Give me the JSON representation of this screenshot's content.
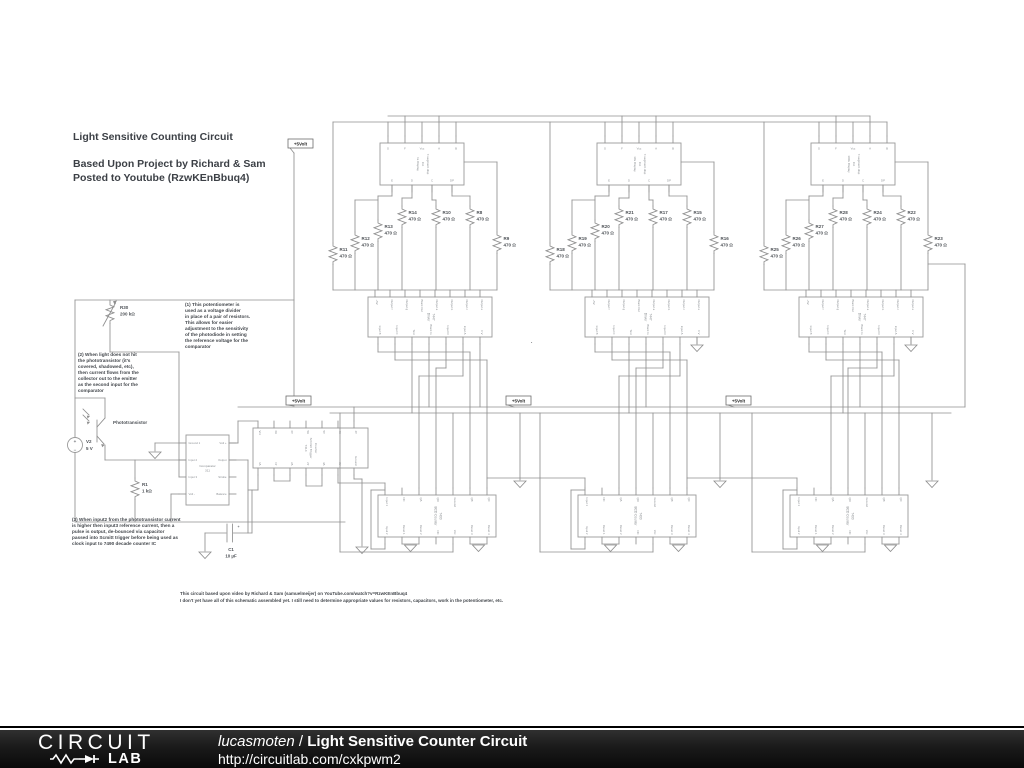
{
  "title": {
    "line1": "Light Sensitive Counting Circuit",
    "line2": "Based Upon Project by Richard & Sam\nPosted to Youtube (RzwKEnBbuq4)"
  },
  "annotations": {
    "note1": "(1) This potentiometer is\nused as a voltage divider\nin place of a pair of resistors.\nThis allows for easier\nadjustment to the sensitivity\nof the photodiode in setting\nthe reference voltage for the\ncomparator",
    "note2": "(2) When light does not hit\nthe phototransistor (it's\ncovered, shadowed, etc),\nthen current flows from the\ncollector out to the emitter\nas the second input for the\ncomparator",
    "note3": "(3) When input2 from the phototransistor current\nis higher then input3 reference current, then a\npulse is output, de-bounced via capacitor\npassed into Scmitt trigger before being used as\nclock input to 7490 decade counter IC",
    "footnote": "This circuit based upon video by Richard & Sam (samuelmeijer) on YouTube.com/watch?v=RzwKEnBbuq4\nI don't yet have all of this schematic assembled yet. I still need to determine appropriate values for resistors, capacitors, work in the potentiometer, etc."
  },
  "schematic": {
    "net_flag": "+5Volt",
    "dot": ".",
    "display": {
      "top_pins": [
        "G",
        "F",
        "Vcc",
        "A",
        "B"
      ],
      "bottom_pins": [
        "E",
        "D",
        "C",
        "DP"
      ]
    },
    "driver": {
      "title_lines": [
        "Driver",
        "7447"
      ],
      "top_pins": [
        "+5V",
        "Output f",
        "Output g",
        "Blank Out",
        "Output a",
        "Output b",
        "Output c",
        "Output e"
      ],
      "bottom_pins": [
        "Input B",
        "Input C",
        "Test",
        "Blank In",
        "Input D",
        "Input A",
        "0 V"
      ]
    },
    "counter": {
      "title_lines": [
        "BCD Counter",
        "7490"
      ],
      "top_pins": [
        "Input 1",
        "NC",
        "QA",
        "QD",
        "Ground",
        "QB",
        "QC"
      ],
      "bottom_pins": [
        "Input 2",
        "Reset 1",
        "Reset 2",
        "NC",
        "Vcc",
        "Reset 3",
        "Reset 4"
      ]
    },
    "schmitt": {
      "title_lines": [
        "7414",
        "Schmitt Trigger",
        "Inverter"
      ],
      "top_pins": [
        "Vcc",
        "6A",
        "6Y",
        "5A",
        "5Y",
        "4A",
        "4Y"
      ],
      "bottom_pins": [
        "1A",
        "1Y",
        "2A",
        "2Y",
        "3A",
        "3Y",
        "Ground"
      ]
    },
    "comparator": {
      "title_lines": [
        "Comparator",
        "311"
      ],
      "left_pins": [
        "Ground 1",
        "Input 2",
        "Input 3",
        "Volt -"
      ],
      "right_pins": [
        "Volt +",
        "Output",
        "Strobe",
        "Balance"
      ]
    },
    "left_parts": {
      "r30": {
        "name": "R30",
        "value": "200 kΩ"
      },
      "photo_label": "Phototransistor",
      "v2": {
        "name": "V2",
        "value": "5 V",
        "plus": "+",
        "minus": "−"
      },
      "r1": {
        "name": "R1",
        "value": "1 kΩ"
      },
      "c1": {
        "name": "C1",
        "value": "10 µF",
        "plus": "+"
      }
    },
    "columns": [
      {
        "display_lines": [
          "1s Display",
          "CA",
          "7-segment disp"
        ],
        "resistors": [
          {
            "name": "R11",
            "value": "470 Ω"
          },
          {
            "name": "R12",
            "value": "470 Ω"
          },
          {
            "name": "R13",
            "value": "470 Ω"
          },
          {
            "name": "R14",
            "value": "470 Ω"
          },
          {
            "name": "R10",
            "value": "470 Ω"
          },
          {
            "name": "R8",
            "value": "470 Ω"
          },
          {
            "name": "R9",
            "value": "470 Ω"
          }
        ]
      },
      {
        "display_lines": [
          "10s Display",
          "CA",
          "7-segment disp"
        ],
        "resistors": [
          {
            "name": "R18",
            "value": "470 Ω"
          },
          {
            "name": "R19",
            "value": "470 Ω"
          },
          {
            "name": "R20",
            "value": "470 Ω"
          },
          {
            "name": "R21",
            "value": "470 Ω"
          },
          {
            "name": "R17",
            "value": "470 Ω"
          },
          {
            "name": "R15",
            "value": "470 Ω"
          },
          {
            "name": "R16",
            "value": "470 Ω"
          }
        ]
      },
      {
        "display_lines": [
          "100s Display",
          "CA",
          "7-segment disp"
        ],
        "resistors": [
          {
            "name": "R25",
            "value": "470 Ω"
          },
          {
            "name": "R26",
            "value": "470 Ω"
          },
          {
            "name": "R27",
            "value": "470 Ω"
          },
          {
            "name": "R28",
            "value": "470 Ω"
          },
          {
            "name": "R24",
            "value": "470 Ω"
          },
          {
            "name": "R22",
            "value": "470 Ω"
          },
          {
            "name": "R23",
            "value": "470 Ω"
          }
        ]
      }
    ]
  },
  "footer": {
    "logo_top": "CIRCUIT",
    "logo_bottom": "LAB",
    "author": "lucasmoten",
    "separator": " / ",
    "title": "Light Sensitive Counter Circuit",
    "url": "http://circuitlab.com/cxkpwm2",
    "bar_color": "#1a1a1a"
  }
}
